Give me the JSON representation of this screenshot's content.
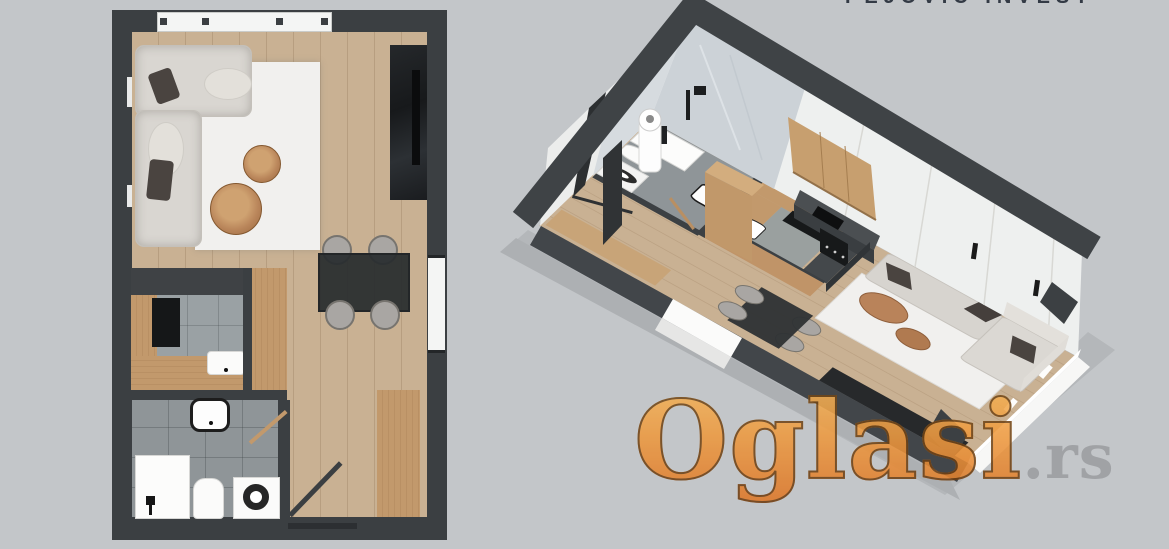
{
  "header": {
    "partial_logo_text": "PEJOVIĆ INVEST"
  },
  "watermark": {
    "brand": "Oglasi",
    "suffix": ".rs"
  },
  "palette": {
    "background": "#c3c6c9",
    "wall_dark": "#3b3f42",
    "wood_floor": "#c9b193",
    "wood_furniture": "#c2996c",
    "sofa": "#d9d6d1",
    "rug": "#f1f0ee",
    "tile_gray": "#9aa1a4",
    "marble": "#d3d8dc",
    "watermark_orange": "#e8923f",
    "watermark_suffix_gray": "#9b9da0"
  }
}
